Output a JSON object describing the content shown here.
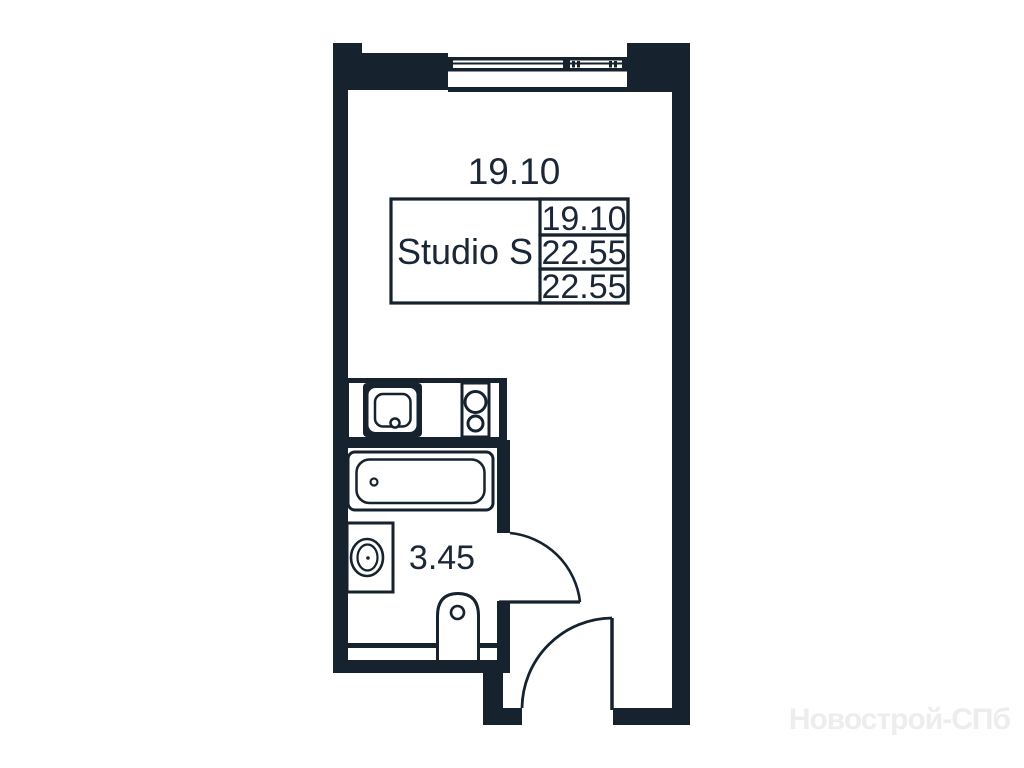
{
  "labels": {
    "room_area": "19.10",
    "bathroom_area": "3.45"
  },
  "info_table": {
    "type_label": "Studio S",
    "values": [
      "19.10",
      "22.55",
      "22.55"
    ]
  },
  "watermark": "Новострой-СПб",
  "colors": {
    "wall": "#16222e",
    "background": "#ffffff",
    "text": "#1b2736",
    "watermark": "#ededed"
  }
}
